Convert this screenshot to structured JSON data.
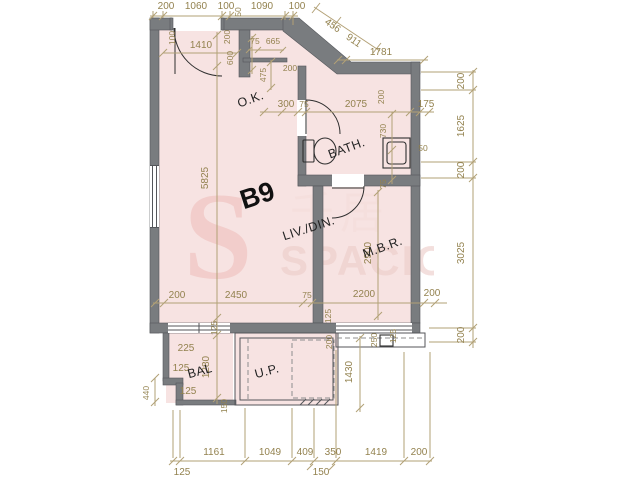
{
  "unit": {
    "label": "B9"
  },
  "rooms": {
    "kitchen": "O.K.",
    "bath": "BATH.",
    "living": "LIV./DIN.",
    "master": "M.B.R.",
    "balcony": "BAL",
    "utility": "U.P."
  },
  "watermark": {
    "initial": "S",
    "cjk": "千居",
    "name": "SPACIOUS"
  },
  "dimensions": {
    "top": [
      "200",
      "1060",
      "100",
      "1090",
      "100"
    ],
    "diagonal": [
      "456",
      "911"
    ],
    "top_right": "1781",
    "right": [
      "200",
      "1625",
      "200",
      "3025",
      "200"
    ],
    "bottom": [
      "125",
      "1161",
      "1049",
      "409",
      "350",
      "1419",
      "200",
      "150"
    ],
    "entry": [
      "100",
      "1410",
      "200",
      "600",
      "50"
    ],
    "niche": [
      "75",
      "665"
    ],
    "corridor": [
      "475",
      "200",
      "300",
      "75"
    ],
    "bath": [
      "2075",
      "200",
      "175",
      "730",
      "50",
      "75"
    ],
    "living": [
      "5825",
      "200",
      "2450",
      "75",
      "2200",
      "200",
      "125",
      "125"
    ],
    "master": "2900",
    "balcony": [
      "225",
      "125",
      "125",
      "440",
      "1280",
      "150"
    ],
    "utility": [
      "200",
      "1430",
      "250",
      "125"
    ]
  },
  "colors": {
    "floor": "#f7e3e2",
    "wall": "#797c7f",
    "dimension": "#93824f",
    "label": "#232323",
    "watermark": "#efc0bd"
  }
}
